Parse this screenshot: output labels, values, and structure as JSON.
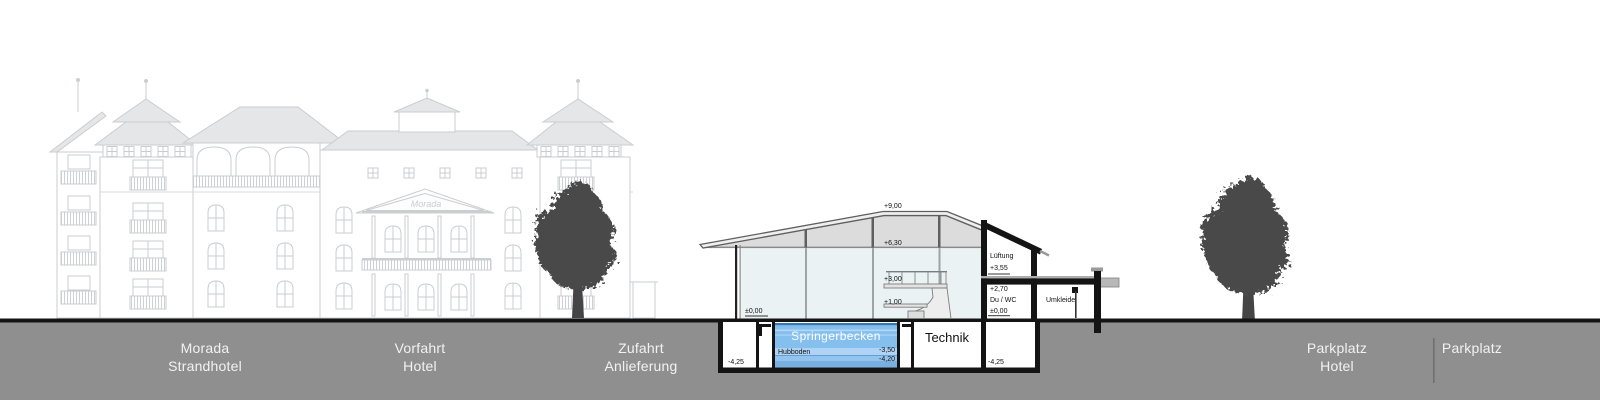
{
  "colors": {
    "ground_gray": "#8f8f8f",
    "ground_line": "#141414",
    "pool_blue": "#85bfee",
    "pool_stripe": "#aed3f5",
    "glass_blue": "#eaf2f3",
    "roof_gray": "#dcdcdc",
    "tree_gray": "#4a4a4a",
    "hotel_faint": "#c9ced1"
  },
  "ground_labels": [
    {
      "id": "morada",
      "line1": "Morada",
      "line2": "Strandhotel"
    },
    {
      "id": "vorfahrt",
      "line1": "Vorfahrt",
      "line2": "Hotel"
    },
    {
      "id": "zufahrt",
      "line1": "Zufahrt",
      "line2": "Anlieferung"
    },
    {
      "id": "parkplatz-hotel",
      "line1": "Parkplatz",
      "line2": "Hotel"
    },
    {
      "id": "parkplatz",
      "line1": "Parkplatz",
      "line2": ""
    }
  ],
  "section": {
    "levels": {
      "roof": "+9,00",
      "ceiling": "+6,30",
      "platform": "+3,00",
      "board": "+1,00",
      "floor": "±0,00"
    },
    "right_block": {
      "room_top": "Lüftung",
      "level_top": "+3,55",
      "level_mid": "+2,70",
      "room_mid": "Du / WC",
      "level_floor": "±0,00",
      "room_side": "Umkleide",
      "level_basement": "-4,25"
    },
    "basement": {
      "level_left": "-4,25",
      "pool_name": "Springerbecken",
      "pool_floor_label": "Hubboden",
      "pool_depth_floor": "-3,50",
      "pool_depth_bottom": "-4,20",
      "tech_room": "Technik"
    }
  },
  "hotel": {
    "logo": "Morada"
  }
}
